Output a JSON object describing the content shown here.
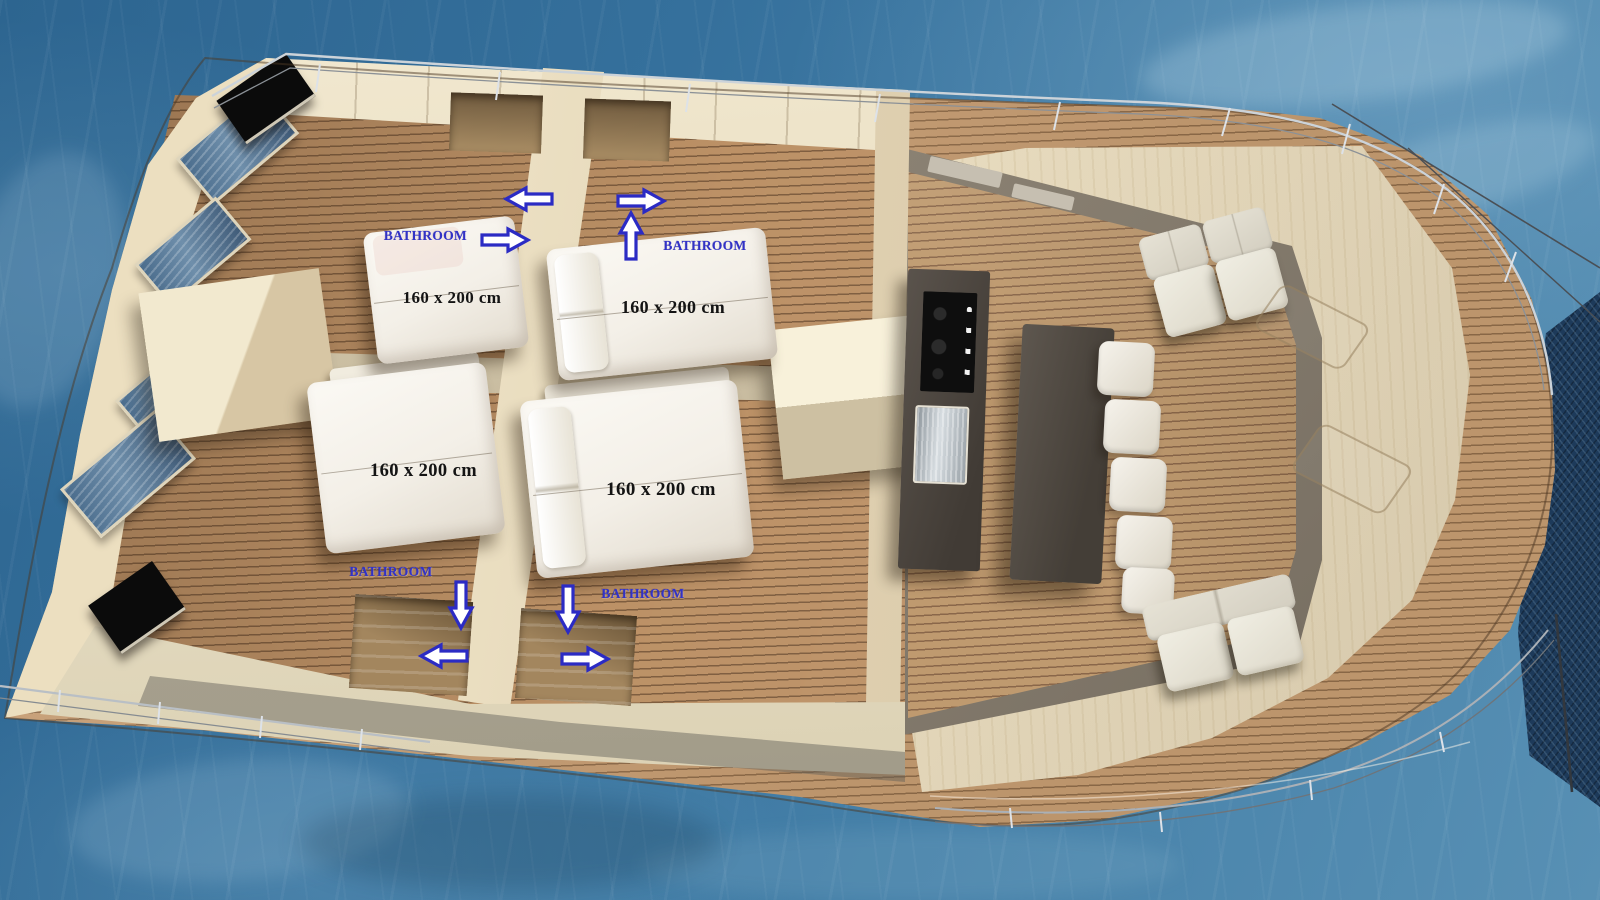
{
  "scene": {
    "render_type": "3d-floorplan",
    "subject": "catamaran-yacht-interior-top-view"
  },
  "cabins": [
    {
      "id": "port-aft",
      "bed_size_label": "160 x 200 cm",
      "bathroom_label": "BATHROOM",
      "bathroom_arrows": [
        "left",
        "right"
      ]
    },
    {
      "id": "port-fore",
      "bed_size_label": "160 x 200 cm",
      "bathroom_label": "BATHROOM",
      "bathroom_arrows": [
        "right",
        "up"
      ]
    },
    {
      "id": "starboard-aft",
      "bed_size_label": "160 x 200 cm",
      "bathroom_label": "BATHROOM",
      "bathroom_arrows": [
        "down",
        "left"
      ]
    },
    {
      "id": "starboard-fore",
      "bed_size_label": "160 x 200 cm",
      "bathroom_label": "BATHROOM",
      "bathroom_arrows": [
        "down",
        "right"
      ]
    }
  ],
  "colors": {
    "water": "#35709c",
    "water_light": "#6fa6c4",
    "deck_wood": "#c89e73",
    "plank_line": "#916d4a",
    "floor_wood": "#bc9166",
    "wall_cream": "#ecdfc0",
    "wall_taupe": "#857c6e",
    "counter_dark": "#453f38",
    "bed_white": "#f3efe7",
    "sofa_cream": "#eceade",
    "window_glass": "#4a6c8c",
    "tv_black": "#0b0b0b",
    "trampoline_net": "#1d3a5a",
    "bed_label_text": "#141414",
    "bathroom_text": "#3232c6",
    "arrow_fill": "#ffffff",
    "arrow_border": "#2b2bc4"
  }
}
